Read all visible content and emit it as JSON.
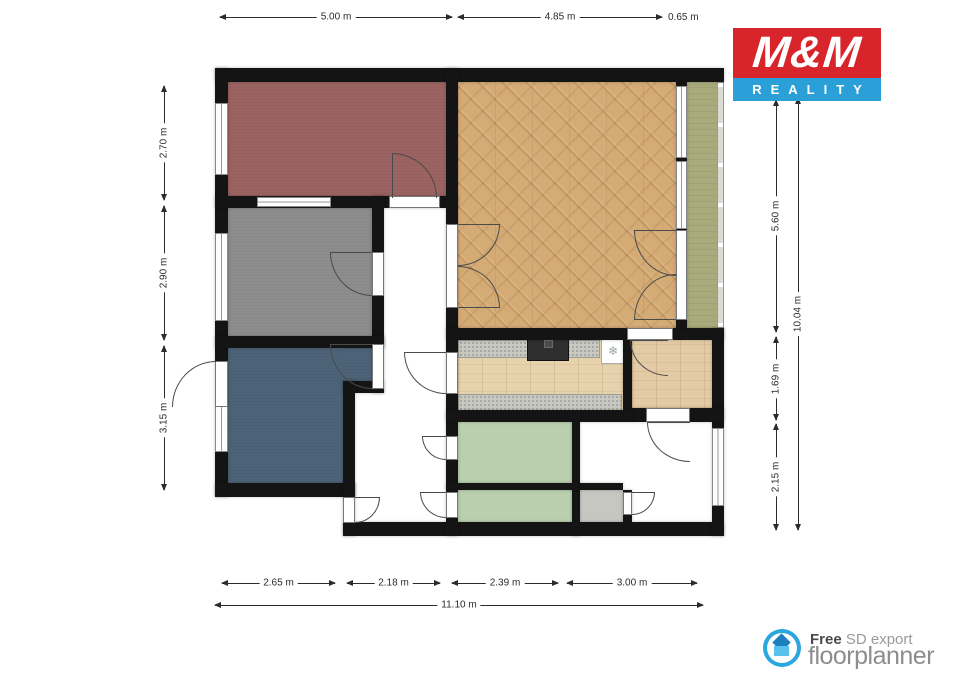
{
  "colors": {
    "wall": "#141414",
    "mm_red": "#d8242b",
    "mm_blue": "#2a9fd8",
    "floorplanner_blue": "#29a7de"
  },
  "rooms": {
    "bedroom_red": {
      "color": "#9b6361",
      "floor": "red carpet"
    },
    "bedroom_gray": {
      "color": "#8d8d8d",
      "floor": "gray carpet"
    },
    "bedroom_blue": {
      "color": "#4d6378",
      "floor": "blue carpet"
    },
    "living_room": {
      "color": "#d4aa75",
      "floor": "herringbone parquet"
    },
    "balcony": {
      "color": "#a9ab7d",
      "floor": "green outdoor"
    },
    "kitchen": {
      "color": "#e7d2ae",
      "floor": "wood plank"
    },
    "side_room": {
      "color": "#e3cba6",
      "floor": "wood plank"
    },
    "bathroom": {
      "color": "#b9cfae",
      "floor": "green tile"
    },
    "wc": {
      "color": "#b9cfae",
      "floor": "green tile"
    },
    "storage": {
      "color": "#c7c7c2",
      "floor": "gray tile"
    }
  },
  "fixtures": {
    "fridge_icon": "❄"
  },
  "dims": {
    "top": [
      "5.00 m",
      "4.85 m",
      "0.65 m"
    ],
    "left": [
      "2.70 m",
      "2.90 m",
      "3.15 m"
    ],
    "right": [
      "5.60 m",
      "1.69 m",
      "2.15 m"
    ],
    "right_total": "10.04 m",
    "bottom": [
      "2.65 m",
      "2.18 m",
      "2.39 m",
      "3.00 m"
    ],
    "bottom_total": "11.10 m"
  },
  "branding": {
    "mm": {
      "title": "M&M",
      "subtitle": "REALITY"
    },
    "floorplanner": {
      "free": "Free",
      "export": " SD export",
      "name": "floorplanner"
    }
  }
}
